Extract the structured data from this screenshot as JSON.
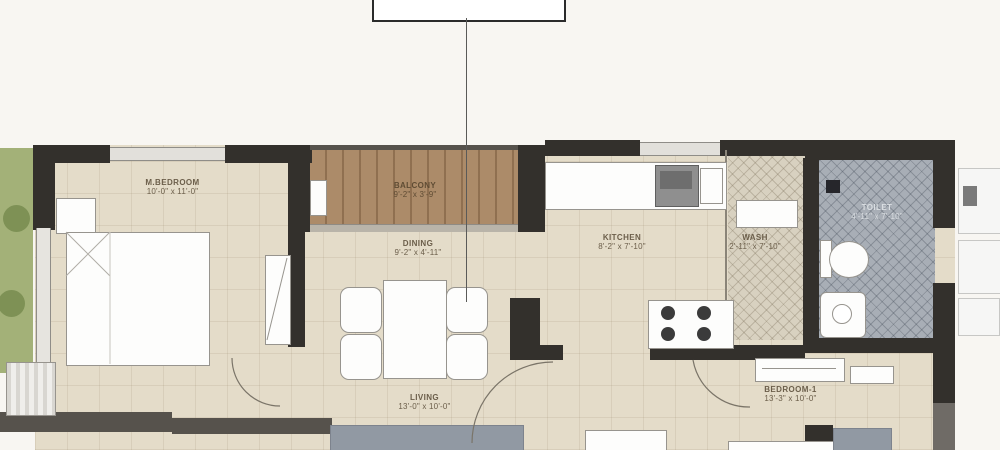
{
  "plan": {
    "type": "apartment-floor-plan",
    "callout": {
      "label": ""
    },
    "rooms": {
      "m_bedroom": {
        "name": "M.BEDROOM",
        "dims": "10'-0\" x 11'-0\""
      },
      "balcony": {
        "name": "BALCONY",
        "dims": "9'-2\" x 3'-9\""
      },
      "dining": {
        "name": "DINING",
        "dims": "9'-2\" x 4'-11\""
      },
      "kitchen": {
        "name": "KITCHEN",
        "dims": "8'-2\" x 7'-10\""
      },
      "wash": {
        "name": "WASH",
        "dims": "2'-11\" x 7'-10\""
      },
      "toilet": {
        "name": "TOILET",
        "dims": "4'-11\" x 7'-10\""
      },
      "living": {
        "name": "LIVING",
        "dims": "13'-0\" x 10'-0\""
      },
      "bedroom1": {
        "name": "BEDROOM-1",
        "dims": "13'-3\" x 10'-0\""
      }
    },
    "colors": {
      "wall": "#33302c",
      "floor": "#e4dcc9",
      "balcony_wood": "#ac8b69",
      "toilet_tile": "#a8aeb6",
      "wash_tile": "#d8d1c0",
      "garden": "#a3b178",
      "garden_bush": "#7e9155",
      "label_text": "#6b5e4a",
      "toilet_label_text": "#dadee2"
    }
  }
}
